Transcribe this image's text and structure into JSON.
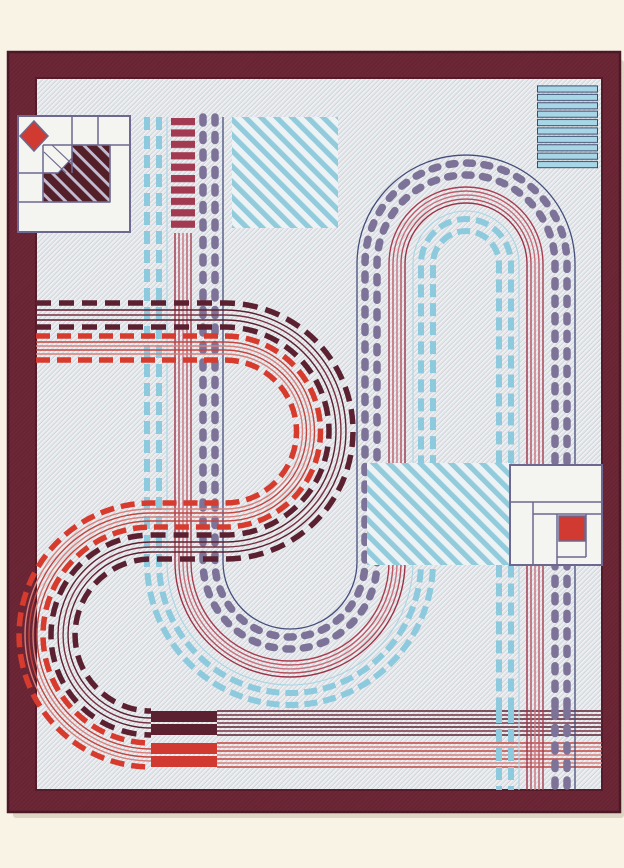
{
  "image": {
    "subject": "woven rug photographed flat: toy road and race-track pattern with quilt-block corner motifs",
    "width_px": 624,
    "height_px": 868
  },
  "colors": {
    "canvas_bg": "#f8f3e5",
    "shadow": "rgba(120,95,70,0.20)",
    "border": "#6e2737",
    "border_edge": "#4c1a26",
    "border_inner_line": "#551d2b",
    "twill_dark": "#dfe6ea",
    "twill_light": "#eff2f4",
    "navy": "#454e7c",
    "purple": "#7d7398",
    "blue": "#8ecadd",
    "blue_light_line": "#a9d6e4",
    "blue_stripe": "#92cbdc",
    "stripe_gap": "#edf2f4",
    "bar_blue": "#a7d7e6",
    "bar_outline": "#3d4a6e",
    "berry": "#a23b52",
    "dark_road": "#5b2130",
    "dark_road_mid": "#7a3242",
    "red_dash": "#d63b2e",
    "red_line": "#c4453f",
    "red_line_light": "#d87f7b",
    "red_band": [
      "#a83e50",
      "#c05a68",
      "#c9737f",
      "#b44e5c",
      "#9c3247"
    ],
    "motif_outline": "#6c6890",
    "motif_fill": "#f4f4f1",
    "motif_dark": "#532029",
    "motif_stripe": "#c3bdd4",
    "red_fill": "#d03a30"
  },
  "motifs": {
    "top_left": "quilt block with red diamond and striped dark squares",
    "top_center": "diagonal blue stripe square",
    "top_right": "horizontal blue bar block",
    "middle_right": "diagonal blue stripe band with log-cabin block and red square",
    "tracks": "purple/blue dashed race loop and red/maroon dashed serpentine road with start-finish blocks"
  }
}
